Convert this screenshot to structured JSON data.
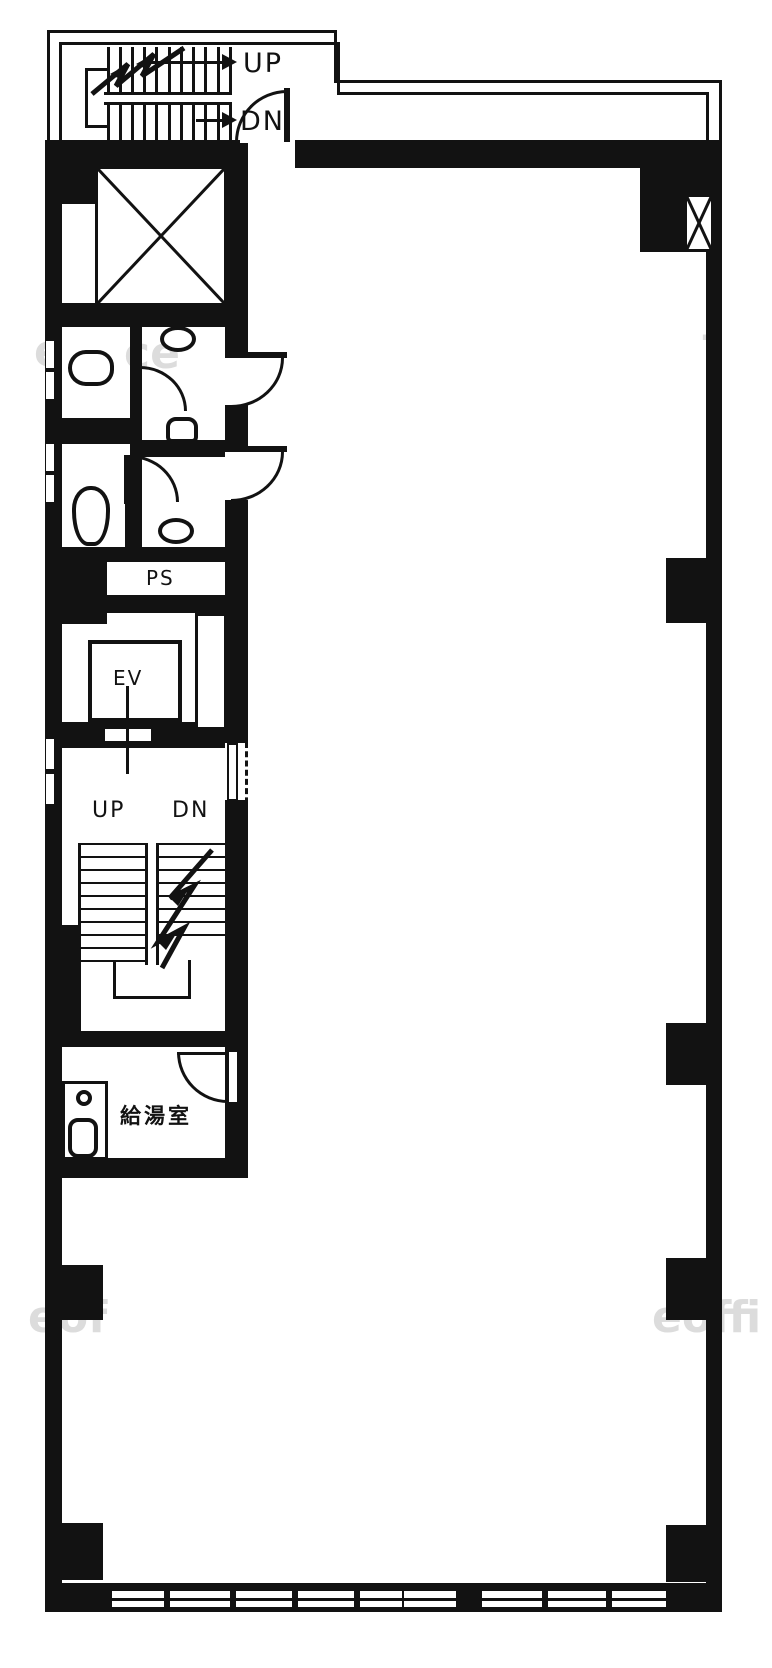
{
  "colors": {
    "ink": "#121212",
    "paper": "#ffffff",
    "watermark": "#c6c6c6"
  },
  "penthouse_stairs": {
    "up_label": "UP",
    "dn_label": "DN"
  },
  "core": {
    "pipe_shaft_label": "PS",
    "elevator_label": "EV",
    "kitchenette_label": "給湯室"
  },
  "main_stairs": {
    "up_label": "UP",
    "dn_label": "DN"
  },
  "watermarks": [
    {
      "text": "e"
    },
    {
      "text": "ce"
    },
    {
      "text": "f"
    },
    {
      "text": "eof"
    },
    {
      "text": "eoffi"
    }
  ]
}
